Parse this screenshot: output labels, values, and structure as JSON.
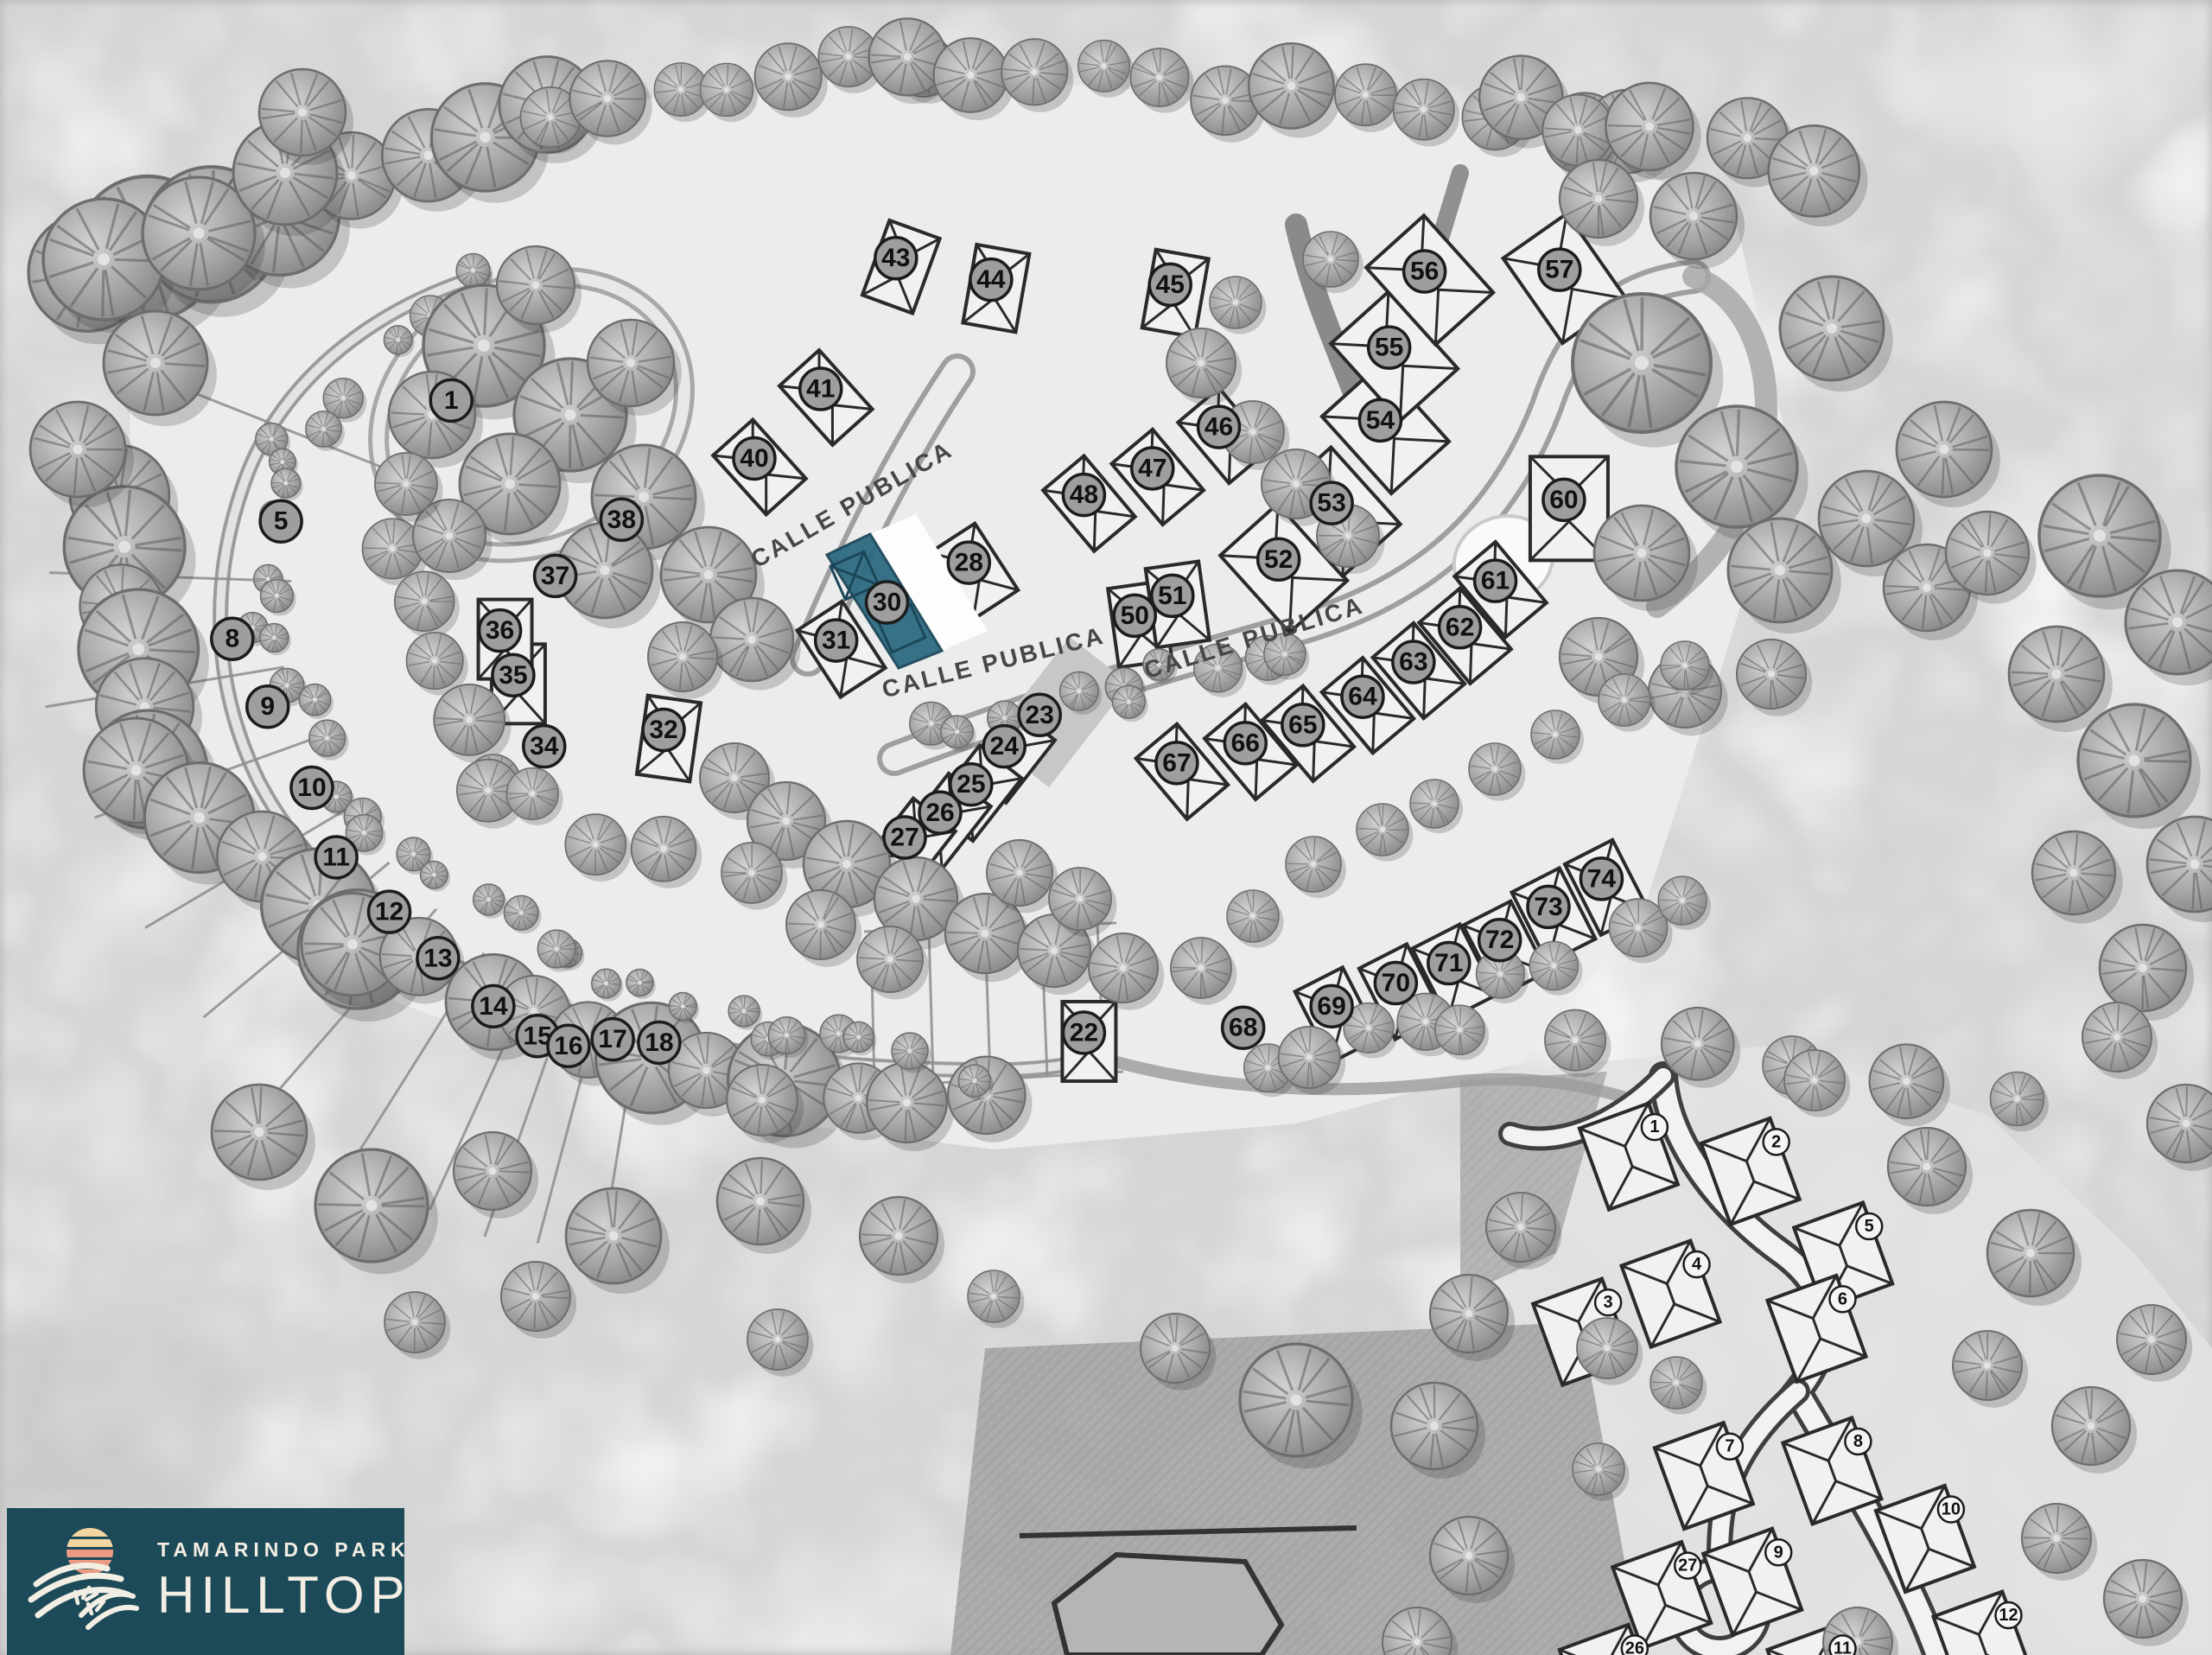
{
  "logo": {
    "park_name": "TAMARINDO PARK",
    "name": "HILLTOP",
    "bg_color": "#1d4a59",
    "text_color": "#f3eee3",
    "sun_top_color": "#f2d5a0",
    "sun_bottom_color": "#ea9a80"
  },
  "highlight": {
    "lot": "30",
    "color": "#2e6b82",
    "roof_color": "#1b4759"
  },
  "streets": [
    {
      "label": "CALLE PUBLICA",
      "x": 38.7,
      "y": 30.9,
      "rotation": -30
    },
    {
      "label": "CALLE PUBLICA",
      "x": 45.0,
      "y": 40.5,
      "rotation": -14
    },
    {
      "label": "CALLE PUBLICA",
      "x": 56.8,
      "y": 39.0,
      "rotation": -17
    }
  ],
  "main_lots": [
    {
      "n": "1",
      "x": 20.4,
      "y": 24.2,
      "vacant": true
    },
    {
      "n": "5",
      "x": 12.7,
      "y": 31.5,
      "vacant": true
    },
    {
      "n": "8",
      "x": 10.5,
      "y": 38.6,
      "vacant": true
    },
    {
      "n": "9",
      "x": 12.1,
      "y": 42.7,
      "vacant": true
    },
    {
      "n": "10",
      "x": 14.1,
      "y": 47.6,
      "vacant": true
    },
    {
      "n": "11",
      "x": 15.2,
      "y": 51.8,
      "vacant": true
    },
    {
      "n": "12",
      "x": 17.6,
      "y": 55.1,
      "vacant": true
    },
    {
      "n": "13",
      "x": 19.8,
      "y": 57.9,
      "vacant": true
    },
    {
      "n": "14",
      "x": 22.3,
      "y": 60.8,
      "vacant": true
    },
    {
      "n": "15",
      "x": 24.3,
      "y": 62.6,
      "vacant": true
    },
    {
      "n": "16",
      "x": 25.7,
      "y": 63.2,
      "vacant": true
    },
    {
      "n": "17",
      "x": 27.7,
      "y": 62.8,
      "vacant": true
    },
    {
      "n": "18",
      "x": 29.8,
      "y": 63.0,
      "vacant": true
    },
    {
      "n": "22",
      "x": 49.0,
      "y": 62.4,
      "vacant": false
    },
    {
      "n": "23",
      "x": 47.0,
      "y": 43.2,
      "vacant": true
    },
    {
      "n": "24",
      "x": 45.4,
      "y": 45.1,
      "vacant": false
    },
    {
      "n": "25",
      "x": 43.9,
      "y": 47.4,
      "vacant": false
    },
    {
      "n": "26",
      "x": 42.5,
      "y": 49.1,
      "vacant": false
    },
    {
      "n": "27",
      "x": 40.9,
      "y": 50.6,
      "vacant": false
    },
    {
      "n": "28",
      "x": 43.8,
      "y": 34.0,
      "vacant": false
    },
    {
      "n": "30",
      "x": 40.1,
      "y": 36.4,
      "vacant": false
    },
    {
      "n": "31",
      "x": 37.8,
      "y": 38.7,
      "vacant": false
    },
    {
      "n": "32",
      "x": 30.0,
      "y": 44.1,
      "vacant": false
    },
    {
      "n": "34",
      "x": 24.6,
      "y": 45.1,
      "vacant": true
    },
    {
      "n": "35",
      "x": 23.2,
      "y": 40.8,
      "vacant": false
    },
    {
      "n": "36",
      "x": 22.6,
      "y": 38.1,
      "vacant": false
    },
    {
      "n": "37",
      "x": 25.1,
      "y": 34.8,
      "vacant": true
    },
    {
      "n": "38",
      "x": 28.1,
      "y": 31.4,
      "vacant": true
    },
    {
      "n": "40",
      "x": 34.1,
      "y": 27.7,
      "vacant": false
    },
    {
      "n": "41",
      "x": 37.1,
      "y": 23.5,
      "vacant": false
    },
    {
      "n": "43",
      "x": 40.5,
      "y": 15.6,
      "vacant": false
    },
    {
      "n": "44",
      "x": 44.8,
      "y": 16.9,
      "vacant": false
    },
    {
      "n": "45",
      "x": 52.9,
      "y": 17.2,
      "vacant": false
    },
    {
      "n": "46",
      "x": 55.1,
      "y": 25.8,
      "vacant": false
    },
    {
      "n": "47",
      "x": 52.1,
      "y": 28.3,
      "vacant": false
    },
    {
      "n": "48",
      "x": 49.0,
      "y": 29.9,
      "vacant": false
    },
    {
      "n": "50",
      "x": 51.3,
      "y": 37.2,
      "vacant": false
    },
    {
      "n": "51",
      "x": 53.0,
      "y": 36.0,
      "vacant": false
    },
    {
      "n": "52",
      "x": 57.8,
      "y": 33.8,
      "vacant": false
    },
    {
      "n": "53",
      "x": 60.2,
      "y": 30.4,
      "vacant": false
    },
    {
      "n": "54",
      "x": 62.4,
      "y": 25.4,
      "vacant": false
    },
    {
      "n": "55",
      "x": 62.8,
      "y": 21.0,
      "vacant": false
    },
    {
      "n": "56",
      "x": 64.4,
      "y": 16.4,
      "vacant": false
    },
    {
      "n": "57",
      "x": 70.5,
      "y": 16.3,
      "vacant": false
    },
    {
      "n": "60",
      "x": 70.7,
      "y": 30.2,
      "vacant": false
    },
    {
      "n": "61",
      "x": 67.6,
      "y": 35.1,
      "vacant": false
    },
    {
      "n": "62",
      "x": 66.0,
      "y": 37.9,
      "vacant": false
    },
    {
      "n": "63",
      "x": 63.9,
      "y": 40.0,
      "vacant": false
    },
    {
      "n": "64",
      "x": 61.6,
      "y": 42.1,
      "vacant": false
    },
    {
      "n": "65",
      "x": 58.9,
      "y": 43.8,
      "vacant": false
    },
    {
      "n": "66",
      "x": 56.3,
      "y": 44.9,
      "vacant": false
    },
    {
      "n": "67",
      "x": 53.2,
      "y": 46.1,
      "vacant": false
    },
    {
      "n": "68",
      "x": 56.2,
      "y": 62.1,
      "vacant": true
    },
    {
      "n": "69",
      "x": 60.2,
      "y": 60.8,
      "vacant": false
    },
    {
      "n": "70",
      "x": 63.1,
      "y": 59.4,
      "vacant": false
    },
    {
      "n": "71",
      "x": 65.5,
      "y": 58.2,
      "vacant": false
    },
    {
      "n": "72",
      "x": 67.8,
      "y": 56.8,
      "vacant": false
    },
    {
      "n": "73",
      "x": 70.0,
      "y": 54.8,
      "vacant": false
    },
    {
      "n": "74",
      "x": 72.4,
      "y": 53.1,
      "vacant": false
    }
  ],
  "villa_lots": [
    {
      "n": "1",
      "x": 74.8,
      "y": 68.1
    },
    {
      "n": "2",
      "x": 80.3,
      "y": 69.0
    },
    {
      "n": "3",
      "x": 72.7,
      "y": 78.7
    },
    {
      "n": "4",
      "x": 76.7,
      "y": 76.4
    },
    {
      "n": "5",
      "x": 84.5,
      "y": 74.1
    },
    {
      "n": "6",
      "x": 83.3,
      "y": 78.5
    },
    {
      "n": "7",
      "x": 78.2,
      "y": 87.4
    },
    {
      "n": "8",
      "x": 84.0,
      "y": 87.1
    },
    {
      "n": "9",
      "x": 80.4,
      "y": 93.8
    },
    {
      "n": "10",
      "x": 88.2,
      "y": 91.2
    },
    {
      "n": "11",
      "x": 83.3,
      "y": 99.6
    },
    {
      "n": "12",
      "x": 90.8,
      "y": 97.6
    },
    {
      "n": "26",
      "x": 73.9,
      "y": 99.6
    },
    {
      "n": "27",
      "x": 76.3,
      "y": 94.6
    }
  ],
  "colors": {
    "ground": "#ececec",
    "tree_fill": "#9e9e9e",
    "lot_circle_fill": "#9e9e9e",
    "villa_circle_fill": "#f5f5f5",
    "road_fill": "#e6e6e6"
  }
}
